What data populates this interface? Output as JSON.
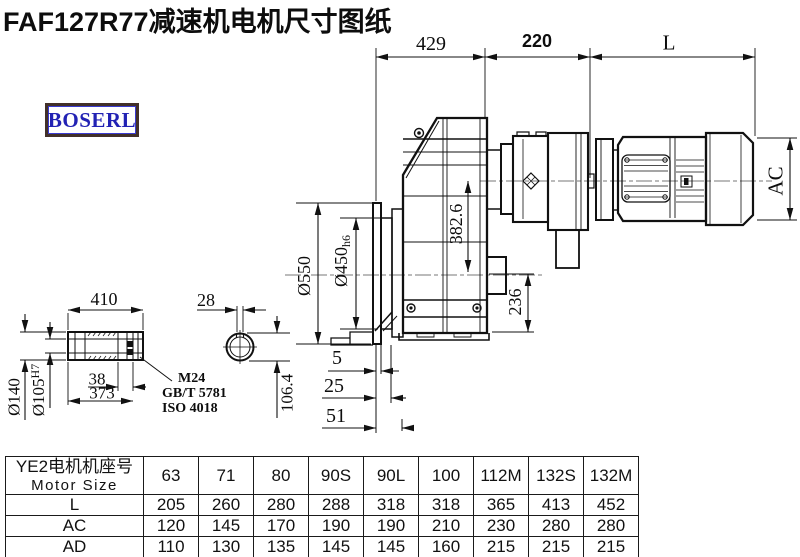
{
  "title": "FAF127R77减速机电机尺寸图纸",
  "logo": "BOSERL",
  "dimensions": {
    "top_429": "429",
    "top_220": "220",
    "top_L": "L",
    "motor_AC": "AC",
    "flange_od": "Ø550",
    "spigot": "Ø450",
    "spigot_tol": "h6",
    "center_height": "382.6",
    "bottom_236": "236",
    "offset_5": "5",
    "offset_25": "25",
    "offset_51": "51",
    "shaft_len": "410",
    "key_width": "28",
    "shaft_od": "Ø140",
    "bore": "Ø105",
    "bore_tol": "H7",
    "end_38": "38",
    "len_373": "373",
    "key_height": "106.4"
  },
  "notes": {
    "bolt": "M24",
    "std1": "GB/T 5781",
    "std2": "ISO 4018"
  },
  "table": {
    "header_cn": "YE2电机机座号",
    "header_en": "Motor Size",
    "columns": [
      "63",
      "71",
      "80",
      "90S",
      "90L",
      "100",
      "112M",
      "132S",
      "132M"
    ],
    "rows": [
      {
        "label": "L",
        "values": [
          "205",
          "260",
          "280",
          "288",
          "318",
          "318",
          "365",
          "413",
          "452"
        ]
      },
      {
        "label": "AC",
        "values": [
          "120",
          "145",
          "170",
          "190",
          "190",
          "210",
          "230",
          "280",
          "280"
        ]
      },
      {
        "label": "AD",
        "values": [
          "110",
          "130",
          "135",
          "145",
          "145",
          "160",
          "215",
          "215",
          "215"
        ]
      }
    ]
  },
  "colors": {
    "line": "#111111",
    "logo_border": "#42302a",
    "logo_text": "#2222b4"
  }
}
